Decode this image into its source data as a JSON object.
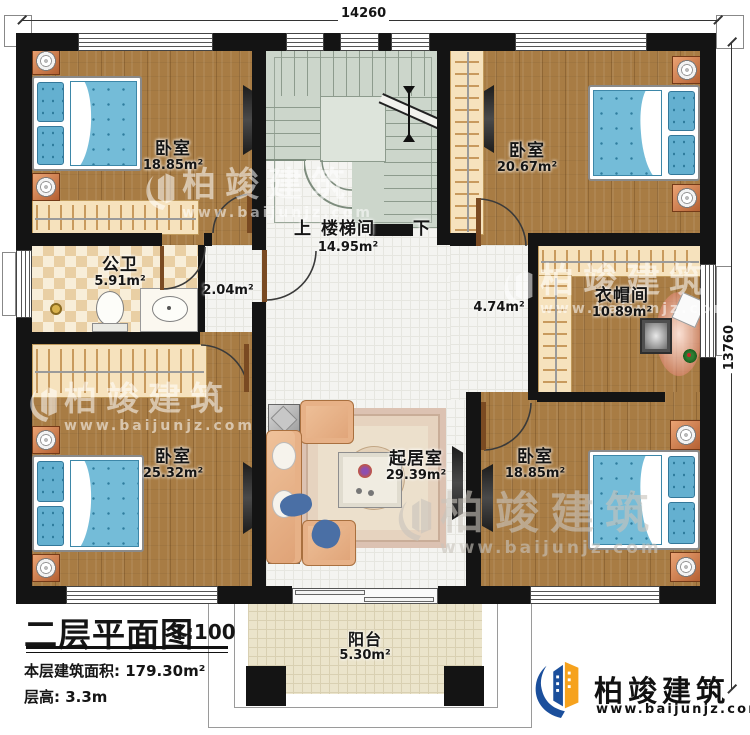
{
  "dims": {
    "top": "14260",
    "right": "13760"
  },
  "rooms": {
    "bedroom_tl": {
      "name": "卧室",
      "area": "18.85m²"
    },
    "bedroom_tr": {
      "name": "卧室",
      "area": "20.67m²"
    },
    "bathroom": {
      "name": "公卫",
      "area": "5.91m²"
    },
    "hall_small": {
      "area": "2.04m²"
    },
    "stair": {
      "up": "上",
      "name": "楼梯间",
      "area": "14.95m²",
      "down": "下"
    },
    "hall_center": {
      "area": "4.74m²"
    },
    "cloakroom": {
      "name": "衣帽间",
      "area": "10.89m²"
    },
    "bedroom_bl": {
      "name": "卧室",
      "area": "25.32m²"
    },
    "living": {
      "name": "起居室",
      "area": "29.39m²"
    },
    "bedroom_br": {
      "name": "卧室",
      "area": "18.85m²"
    },
    "balcony": {
      "name": "阳台",
      "area": "5.30m²"
    }
  },
  "title_block": {
    "title": "二层平面图",
    "scale": "1:100",
    "area_line": "本层建筑面积: 179.30m²",
    "height_line": "层高: 3.3m"
  },
  "brand": {
    "name": "柏竣建筑",
    "url": "www.baijunjz.com"
  },
  "colors": {
    "wall": "#141414",
    "wood_floor": "#a87c44",
    "stair_floor": "#ccd6cb",
    "bed_blue": "#74bcd8",
    "closet_tan": "#f6e2bd",
    "brand_blue": "#1b4f9c",
    "brand_orange": "#f6a21d"
  }
}
